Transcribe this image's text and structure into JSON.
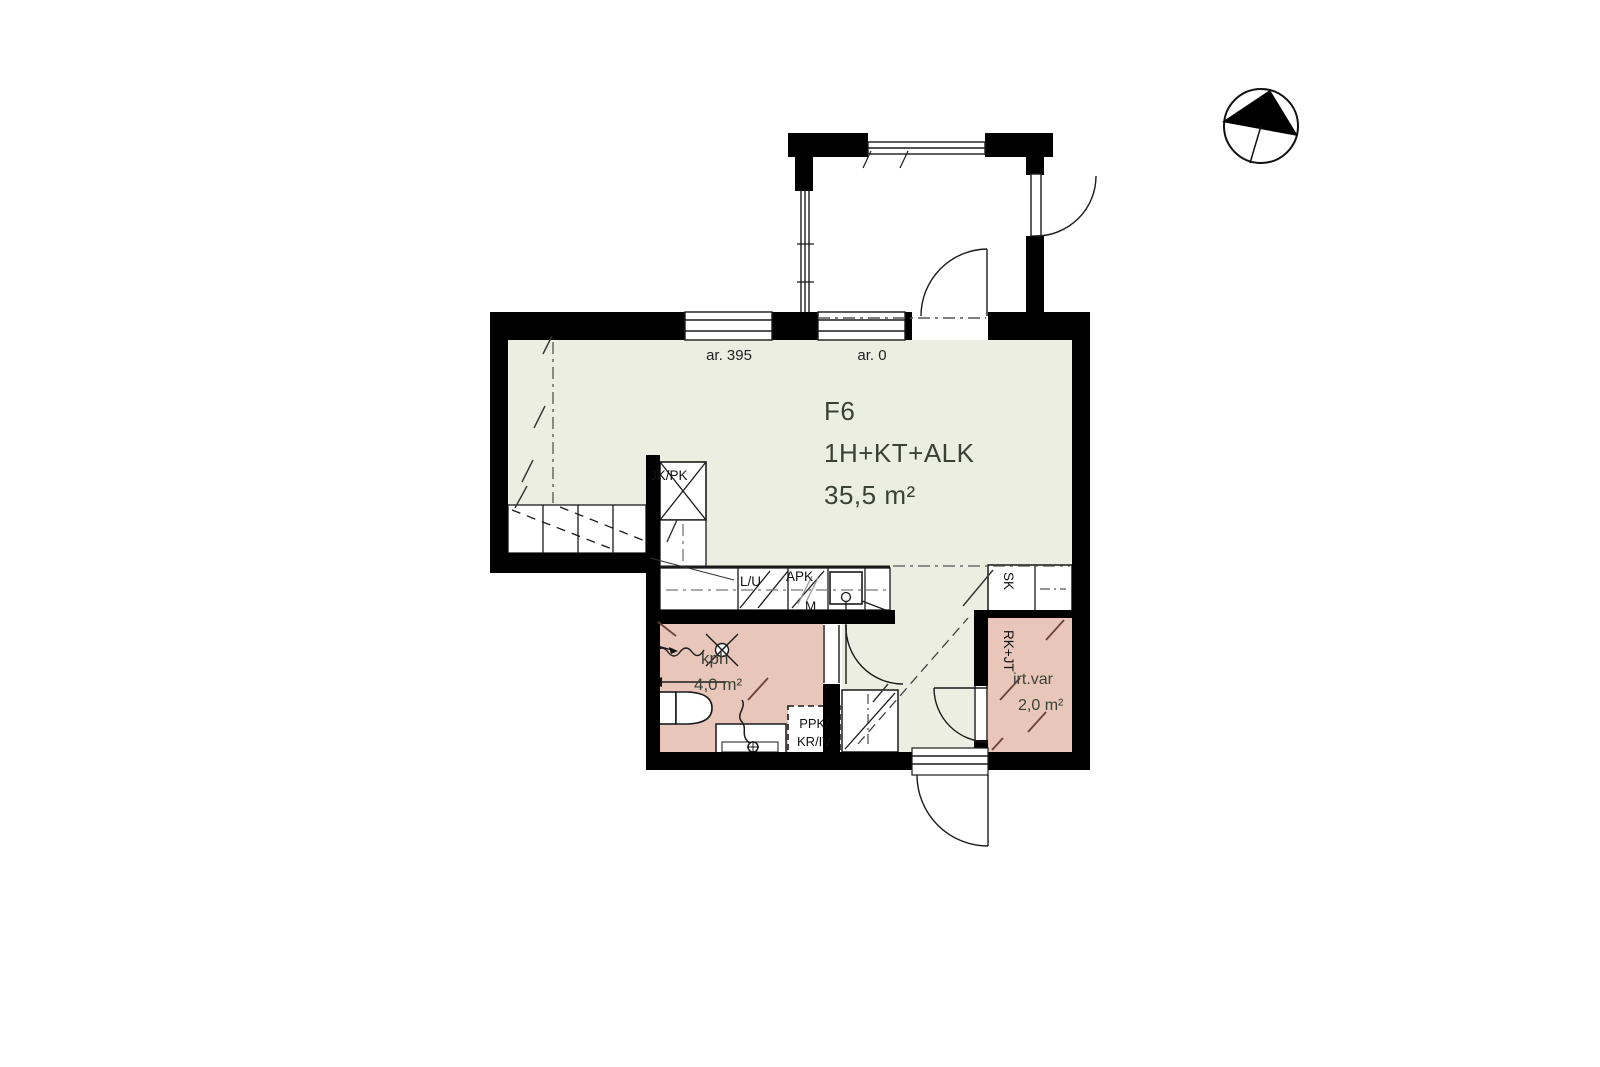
{
  "unit": {
    "id": "F6",
    "layout": "1H+KT+ALK",
    "area": "35,5 m²"
  },
  "rooms": {
    "bathroom": {
      "name": "kph",
      "area": "4,0 m²"
    },
    "storage": {
      "name": "irt.var",
      "area": "2,0 m²"
    }
  },
  "elevations": {
    "window": "ar. 395",
    "balcony_door": "ar. 0"
  },
  "labels": {
    "fridge_freezer": "JK/PK",
    "stove_oven": "L/U",
    "dishwasher": "APK",
    "microwave": "M",
    "washer_line1": "PPK/",
    "washer_line2": "KR/IV",
    "cleaning_closet": "SK",
    "utility_riser": "RK+JT"
  },
  "icons": {
    "north_arrow": "north-arrow-compass"
  },
  "colors": {
    "living_area": "#ebeee0",
    "wet_area": "#e8c6ba",
    "wall": "#000000",
    "hatch": "#6d4038"
  }
}
